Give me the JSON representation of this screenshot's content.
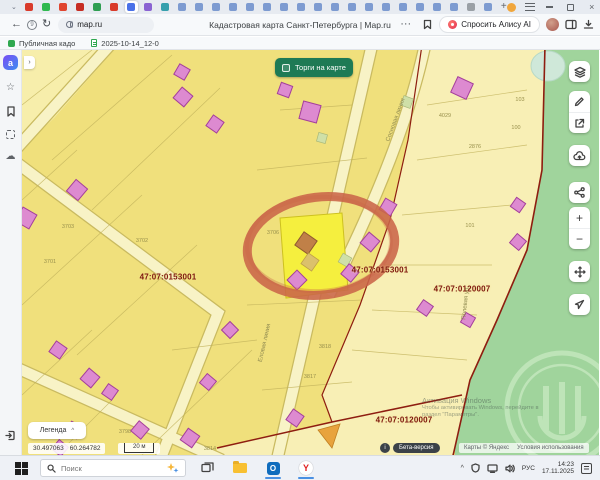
{
  "browser": {
    "page_title": "Кадастровая карта Санкт-Петербурга | Map.ru",
    "url": "map.ru",
    "ask_alice_label": "Спросить Алису AI",
    "new_tab_label": "+",
    "active_tab_index": 6,
    "tab_favicons": [
      "#d93b2b",
      "#2fb94f",
      "#e0452f",
      "#c62d23",
      "#2f9e52",
      "#d93b2b",
      "#4a71e8",
      "#8a63d2",
      "#36a0ad",
      "#7d9bd1",
      "#7d9bd1",
      "#7d9bd1",
      "#7d9bd1",
      "#7d9bd1",
      "#7d9bd1",
      "#7d9bd1",
      "#7d9bd1",
      "#7d9bd1",
      "#7d9bd1",
      "#7d9bd1",
      "#7d9bd1",
      "#7d9bd1",
      "#7d9bd1",
      "#7d9bd1",
      "#7d9bd1",
      "#7d9bd1",
      "#9aa0a6",
      "#7d9bd1"
    ],
    "bookmarks": [
      {
        "label": "Публичная кадо"
      },
      {
        "label": "2025-10-14_12-0"
      }
    ]
  },
  "map": {
    "torgi_button_label": "Торги на карте",
    "legend_button_label": "Легенда",
    "quarter_labels": [
      {
        "text": "47:07:0153001"
      },
      {
        "text": "47:07:0153001"
      },
      {
        "text": "47:07:0120007"
      },
      {
        "text": "47:07:0120007"
      }
    ],
    "selected_parcel_number": "3706",
    "parcel_numbers": [
      {
        "text": "3706"
      },
      {
        "text": "3701"
      },
      {
        "text": "3702"
      },
      {
        "text": "3703"
      },
      {
        "text": "3818"
      },
      {
        "text": "3817"
      },
      {
        "text": "4029"
      },
      {
        "text": "2876"
      },
      {
        "text": "103"
      },
      {
        "text": "100"
      },
      {
        "text": "101"
      },
      {
        "text": "3798"
      },
      {
        "text": "3814"
      }
    ],
    "street_labels": [
      {
        "text": "Сосновая линия"
      },
      {
        "text": "Еловая линия"
      },
      {
        "text": "Полевая ул."
      }
    ],
    "status_bar": {
      "longitude": "30.497063",
      "latitude": "60.264782",
      "scale_label": "20 м",
      "beta_info": "i",
      "beta_label": "Бета-версия",
      "attribution": "Карты © Яндекс",
      "terms": "Условия использования"
    },
    "activation_watermark": {
      "line1": "Активация Windows",
      "line2": "Чтобы активировать Windows, перейдите в",
      "line3": "раздел \"Параметры\"."
    },
    "colors": {
      "parcel_yellow": "#f0e07c",
      "parcel_pale": "#f8efb5",
      "building_pink": "#dd8ad0",
      "forest_green": "#a0d49c",
      "selection_yellow": "#f5ef3e",
      "annotation_red": "#c96549",
      "boundary_red": "#8e1d10"
    }
  },
  "taskbar": {
    "search_placeholder": "Поиск",
    "language": "РУС",
    "time": "14:23",
    "date": "17.11.2025"
  }
}
